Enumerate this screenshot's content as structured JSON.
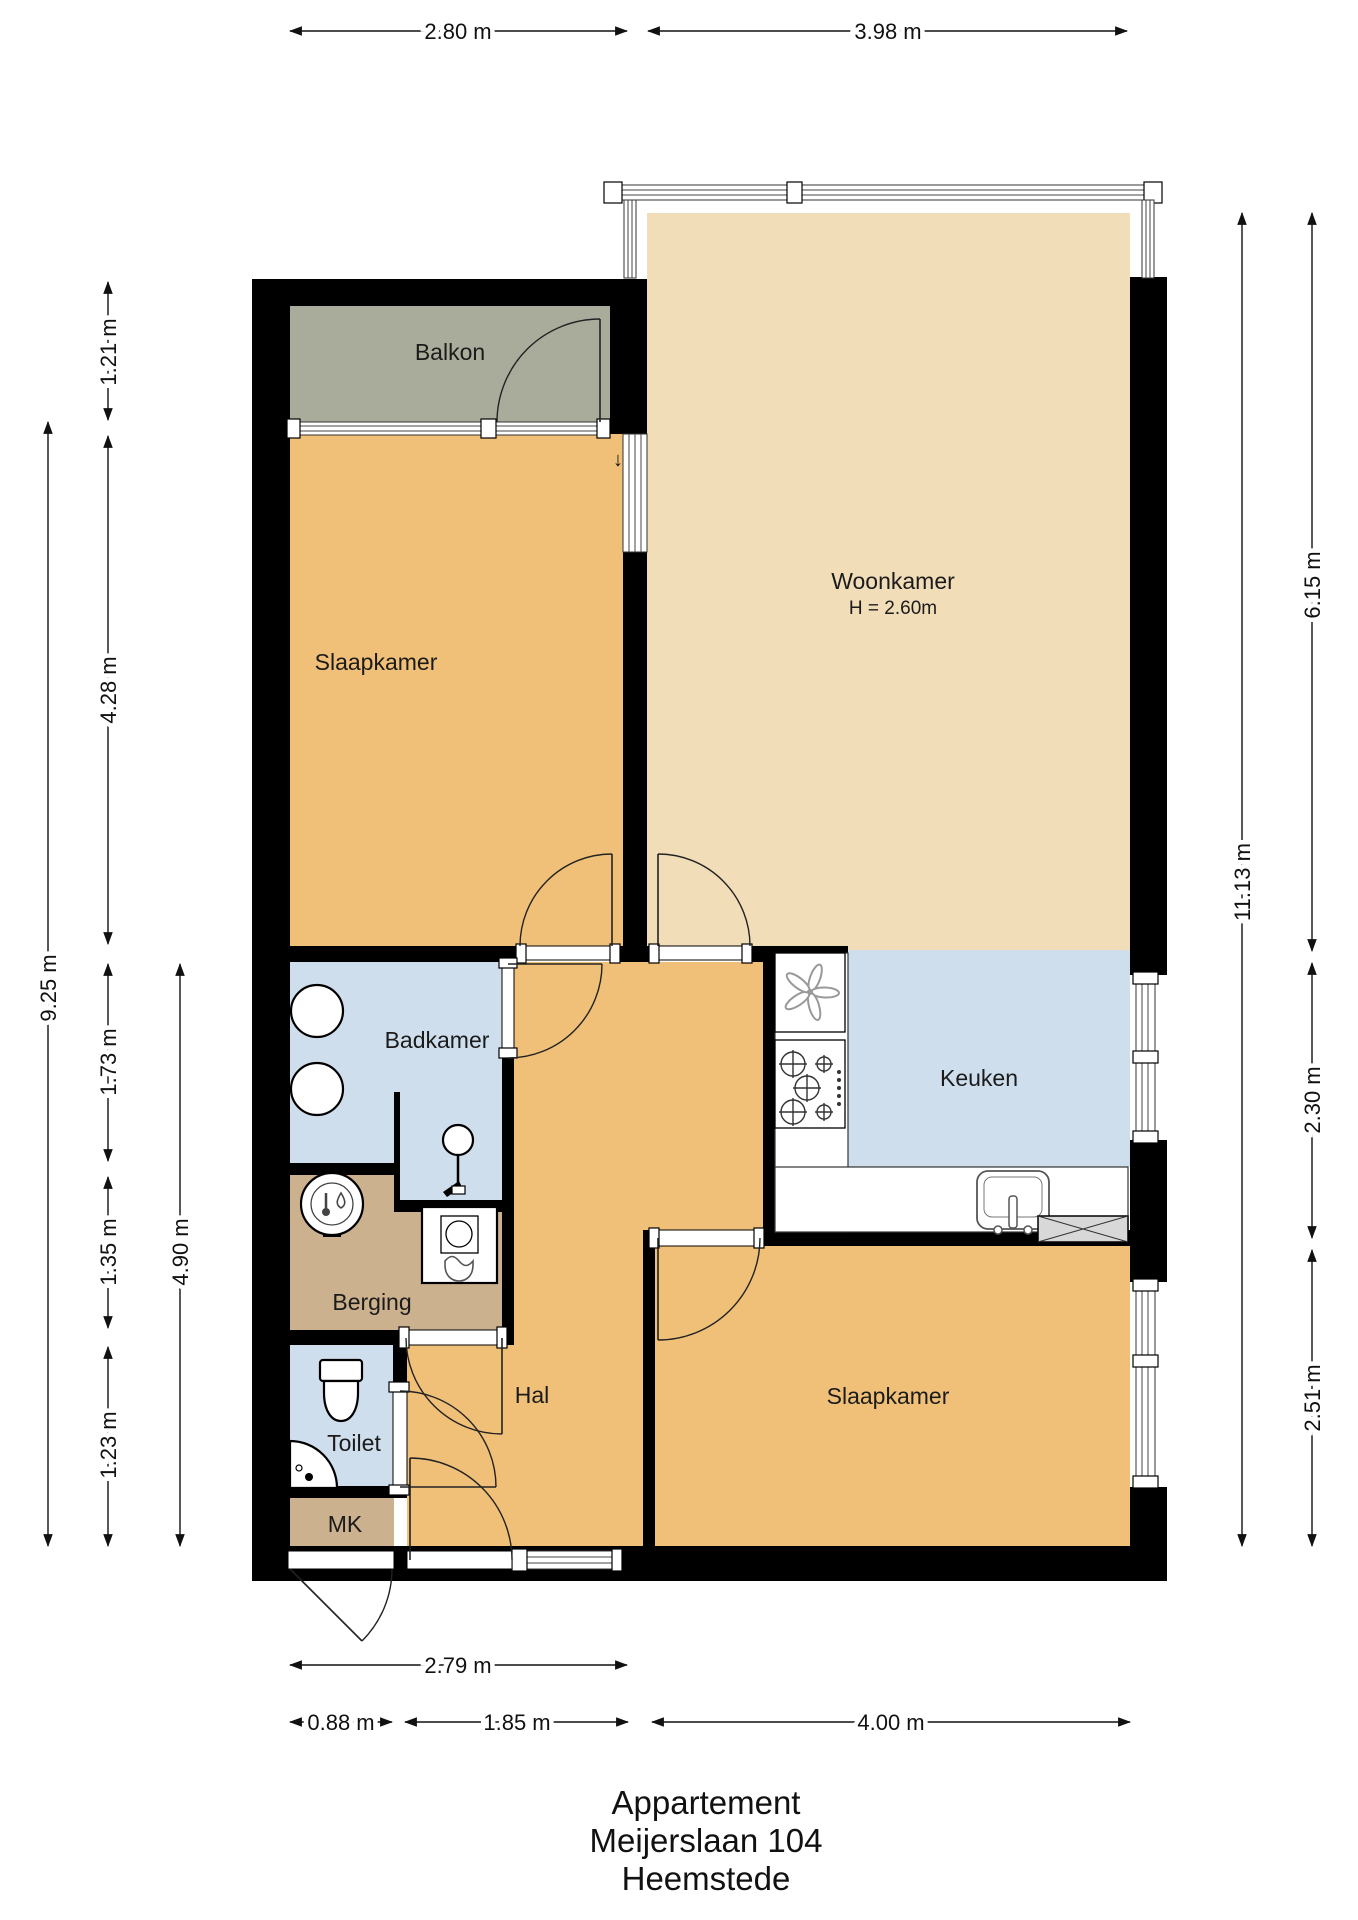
{
  "title": {
    "lines": {
      "l1": "Appartement",
      "l2": "Meijerslaan 104",
      "l3": "Heemstede"
    }
  },
  "rooms": {
    "balkon": "Balkon",
    "slaapkamer1": "Slaapkamer",
    "woonkamer": "Woonkamer",
    "woonkamer_height": "H = 2.60m",
    "badkamer": "Badkamer",
    "keuken": "Keuken",
    "berging": "Berging",
    "hal": "Hal",
    "toilet": "Toilet",
    "mk": "MK",
    "slaapkamer2": "Slaapkamer"
  },
  "dimensions": {
    "top": {
      "left_section": "2.80 m",
      "right_section": "3.98 m"
    },
    "bottom": {
      "hall_total": "2.79 m",
      "mk_width": "0.88 m",
      "hal_width": "1.85 m",
      "bedroom2_width": "4.00 m"
    },
    "left": {
      "balcony_depth": "1.21 m",
      "bedroom1_depth": "4.28 m",
      "total": "9.25 m",
      "bathroom_depth": "1.73 m",
      "storage_depth": "1.35 m",
      "lower_total": "4.90 m",
      "toilet_depth": "1.23 m"
    },
    "right": {
      "living_depth": "6.15 m",
      "total": "11.13 m",
      "kitchen_depth": "2.30 m",
      "bedroom2_depth": "2.51 m"
    }
  },
  "glyphs": {
    "down_arrow": "↓"
  },
  "colors": {
    "bedroom": "#F0C078",
    "living": "#F2DDB9",
    "balcony": "#A9AC9B",
    "wet": "#CFDEEC",
    "storage": "#CBB18E",
    "shaft": "#D8D8D8",
    "wall": "#000000"
  }
}
